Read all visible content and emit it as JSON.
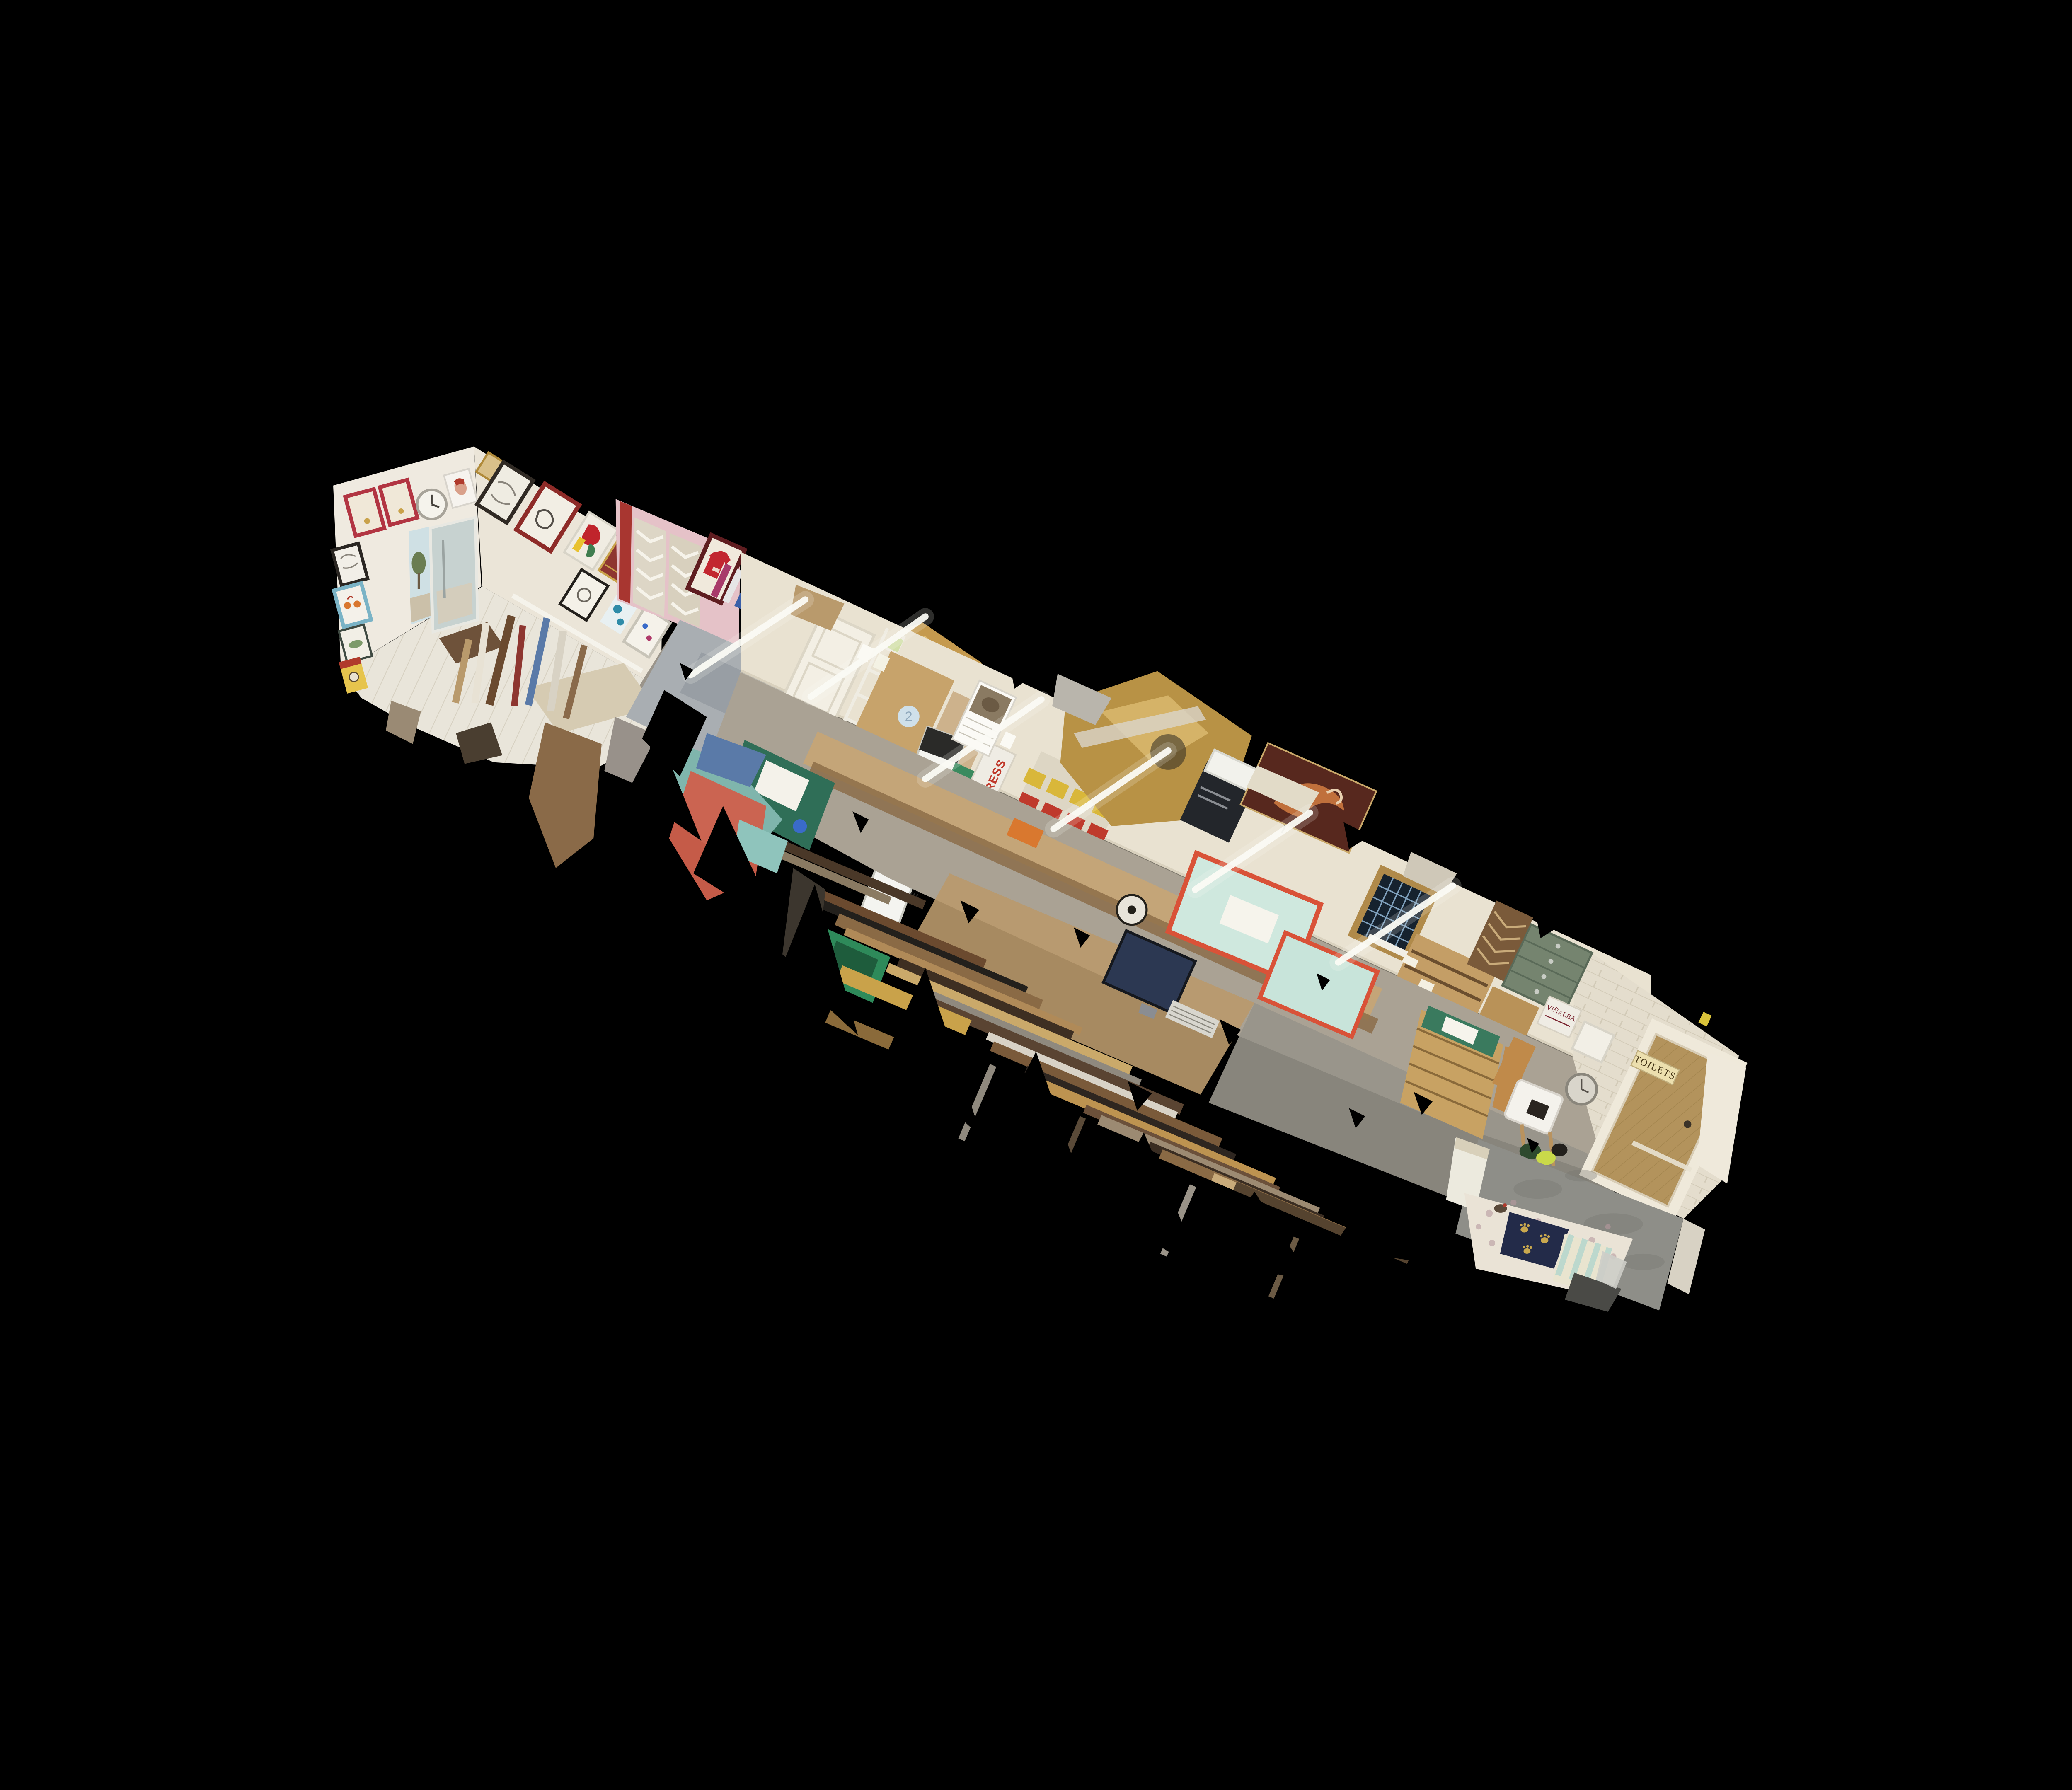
{
  "scene": {
    "type": "3d-dollhouse-scan-view",
    "subject": "picture framing workshop and art gallery interior scan floating on black",
    "background": "#000000"
  },
  "labels": {
    "toilets_sign": "TOILETS",
    "cutter_brand": "EXCALIBUR",
    "box_stamp": "CSWHIT",
    "wine_box": "VIÑALBA",
    "press_box": "PRESS",
    "wall_sticker": "2"
  },
  "palette": {
    "background": "#000000",
    "gallery_wall": "#efeae0",
    "gallery_wall_side": "#ebe5d8",
    "workshop_wall": "#e9e2d1",
    "pink_alcove": "#e5c2c8",
    "red_frame": "#a83630",
    "floor_planks": "#e9e5da",
    "floor_concrete": "#8e8e88",
    "floor_wood": "#b9996b",
    "teal_table": "#cfe8de",
    "table_trim": "#d95238",
    "cutting_mat_green": "#2f6e57",
    "wood_light": "#c9a469",
    "wood_mid": "#8a6a45",
    "wood_dark": "#3e2f22",
    "gold": "#bd9350",
    "brick_white": "#e4ddcd",
    "door_tan": "#b3935c",
    "navy_blanket": "#232b49",
    "tube_light": "#fbfbf5",
    "gray_slab": "#a9aeb2"
  },
  "sections": [
    {
      "id": "gallery",
      "name": "front-gallery"
    },
    {
      "id": "pink-alcove",
      "name": "moulding-display-alcove"
    },
    {
      "id": "workshop",
      "name": "framing-workshop"
    },
    {
      "id": "moulding-racks",
      "name": "moulding-storage-racks"
    },
    {
      "id": "brick-toilets",
      "name": "brick-wall-toilets-door"
    },
    {
      "id": "annex",
      "name": "rear-annex-dog-bed"
    }
  ]
}
